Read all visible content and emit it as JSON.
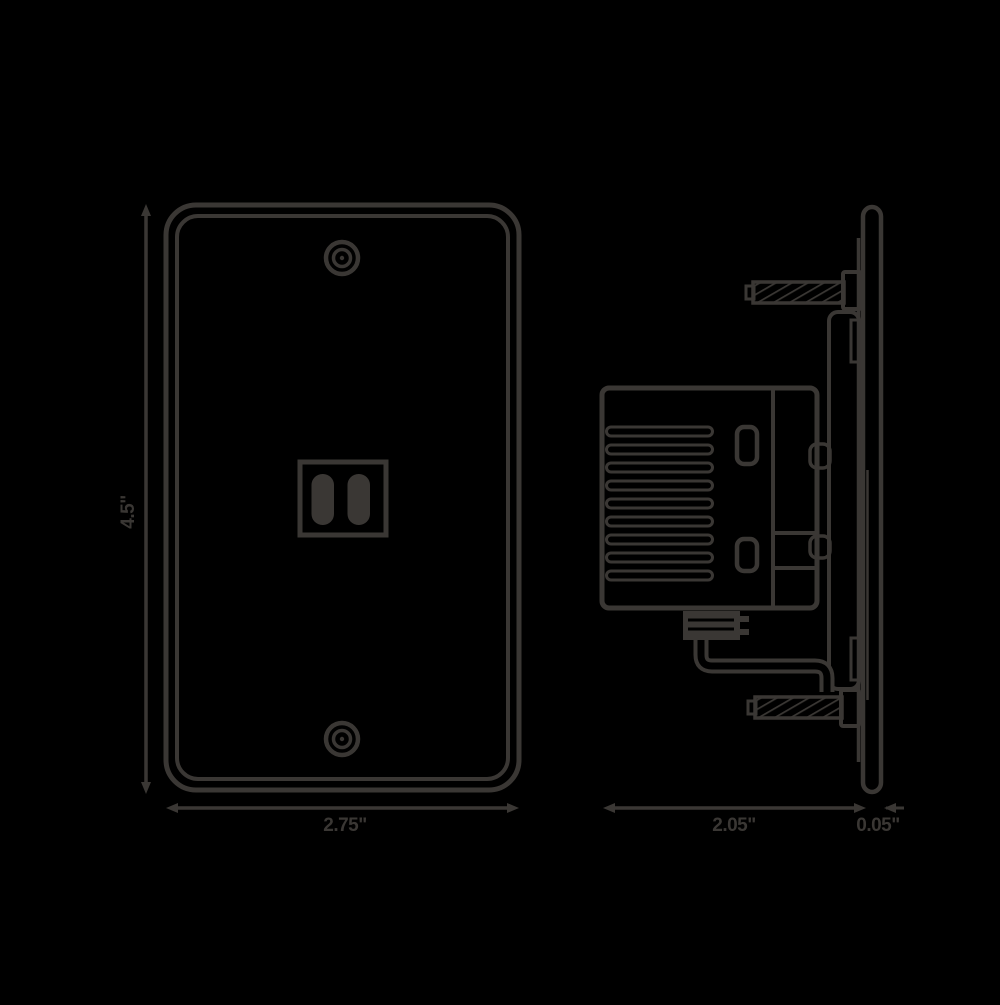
{
  "colors": {
    "ink": "#3a3734",
    "background": "#000000"
  },
  "dimensions": {
    "front_height": {
      "label": "4.5\""
    },
    "front_width": {
      "label": "2.75\""
    },
    "side_depth": {
      "label": "2.05\""
    },
    "side_plate_thickness": {
      "label": "0.05\""
    }
  }
}
